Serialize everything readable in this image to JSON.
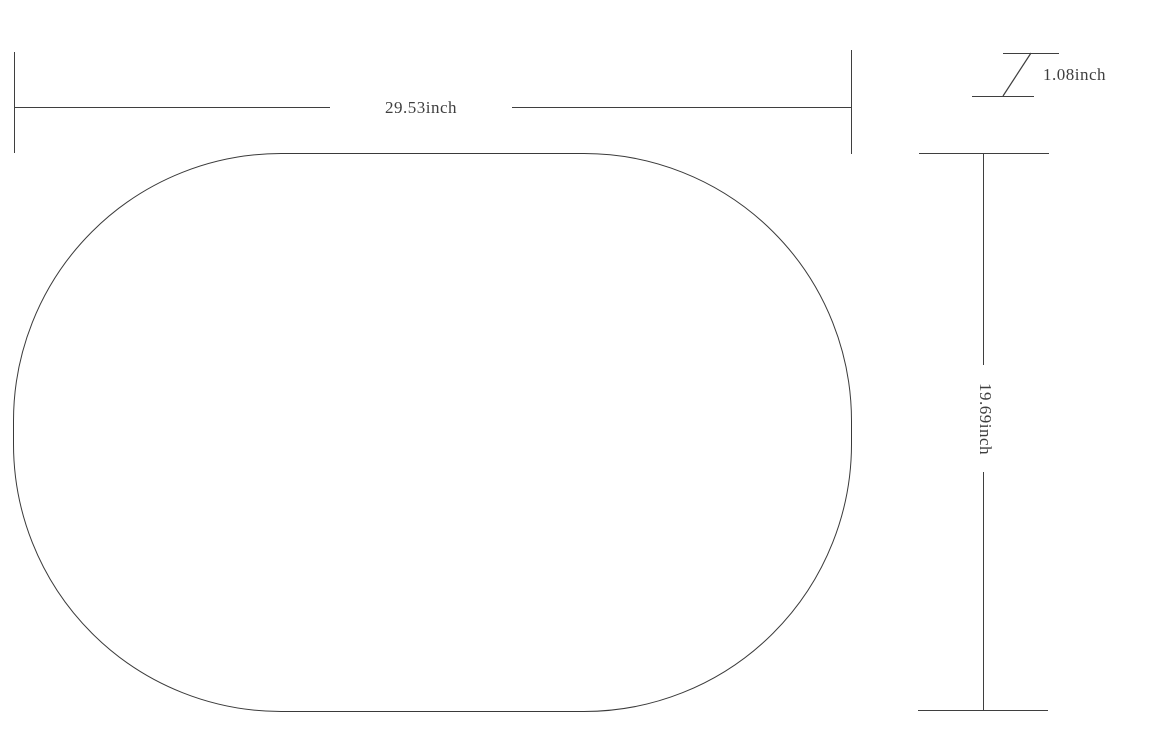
{
  "page": {
    "background_color": "#ffffff",
    "line_color": "#3f3f3f",
    "text_color": "#3f3f3f"
  },
  "diagram": {
    "shape": "rounded-oval-outline",
    "width_dim": {
      "label": "29.53inch"
    },
    "height_dim": {
      "label": "19.69inch"
    },
    "thickness_dim": {
      "label": "1.08inch"
    }
  }
}
